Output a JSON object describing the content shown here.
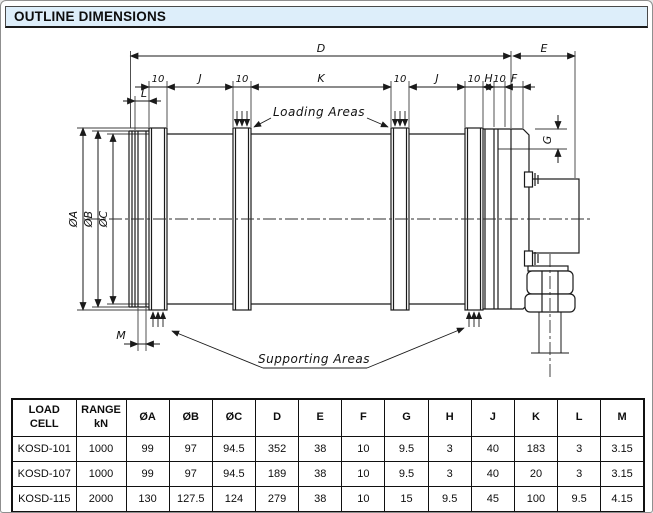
{
  "header": {
    "title": "OUTLINE DIMENSIONS"
  },
  "drawing": {
    "dims": {
      "d": "D",
      "e": "E",
      "ten": "10",
      "j": "J",
      "k": "K",
      "h": "H",
      "f": "F",
      "l": "L",
      "m": "M",
      "g": "G",
      "dia_a": "ØA",
      "dia_b": "ØB",
      "dia_c": "ØC"
    },
    "annotations": {
      "loading": "Loading Areas",
      "supporting": "Supporting Areas"
    }
  },
  "table": {
    "headers": [
      "LOAD CELL",
      "RANGE kN",
      "ØA",
      "ØB",
      "ØC",
      "D",
      "E",
      "F",
      "G",
      "H",
      "J",
      "K",
      "L",
      "M"
    ],
    "rows": [
      [
        "KOSD-101",
        "1000",
        "99",
        "97",
        "94.5",
        "352",
        "38",
        "10",
        "9.5",
        "3",
        "40",
        "183",
        "3",
        "3.15"
      ],
      [
        "KOSD-107",
        "1000",
        "99",
        "97",
        "94.5",
        "189",
        "38",
        "10",
        "9.5",
        "3",
        "40",
        "20",
        "3",
        "3.15"
      ],
      [
        "KOSD-115",
        "2000",
        "130",
        "127.5",
        "124",
        "279",
        "38",
        "10",
        "15",
        "9.5",
        "45",
        "100",
        "9.5",
        "4.15"
      ]
    ]
  },
  "colors": {
    "header_bg": "#ddeefa",
    "line": "#1a1a1a"
  }
}
